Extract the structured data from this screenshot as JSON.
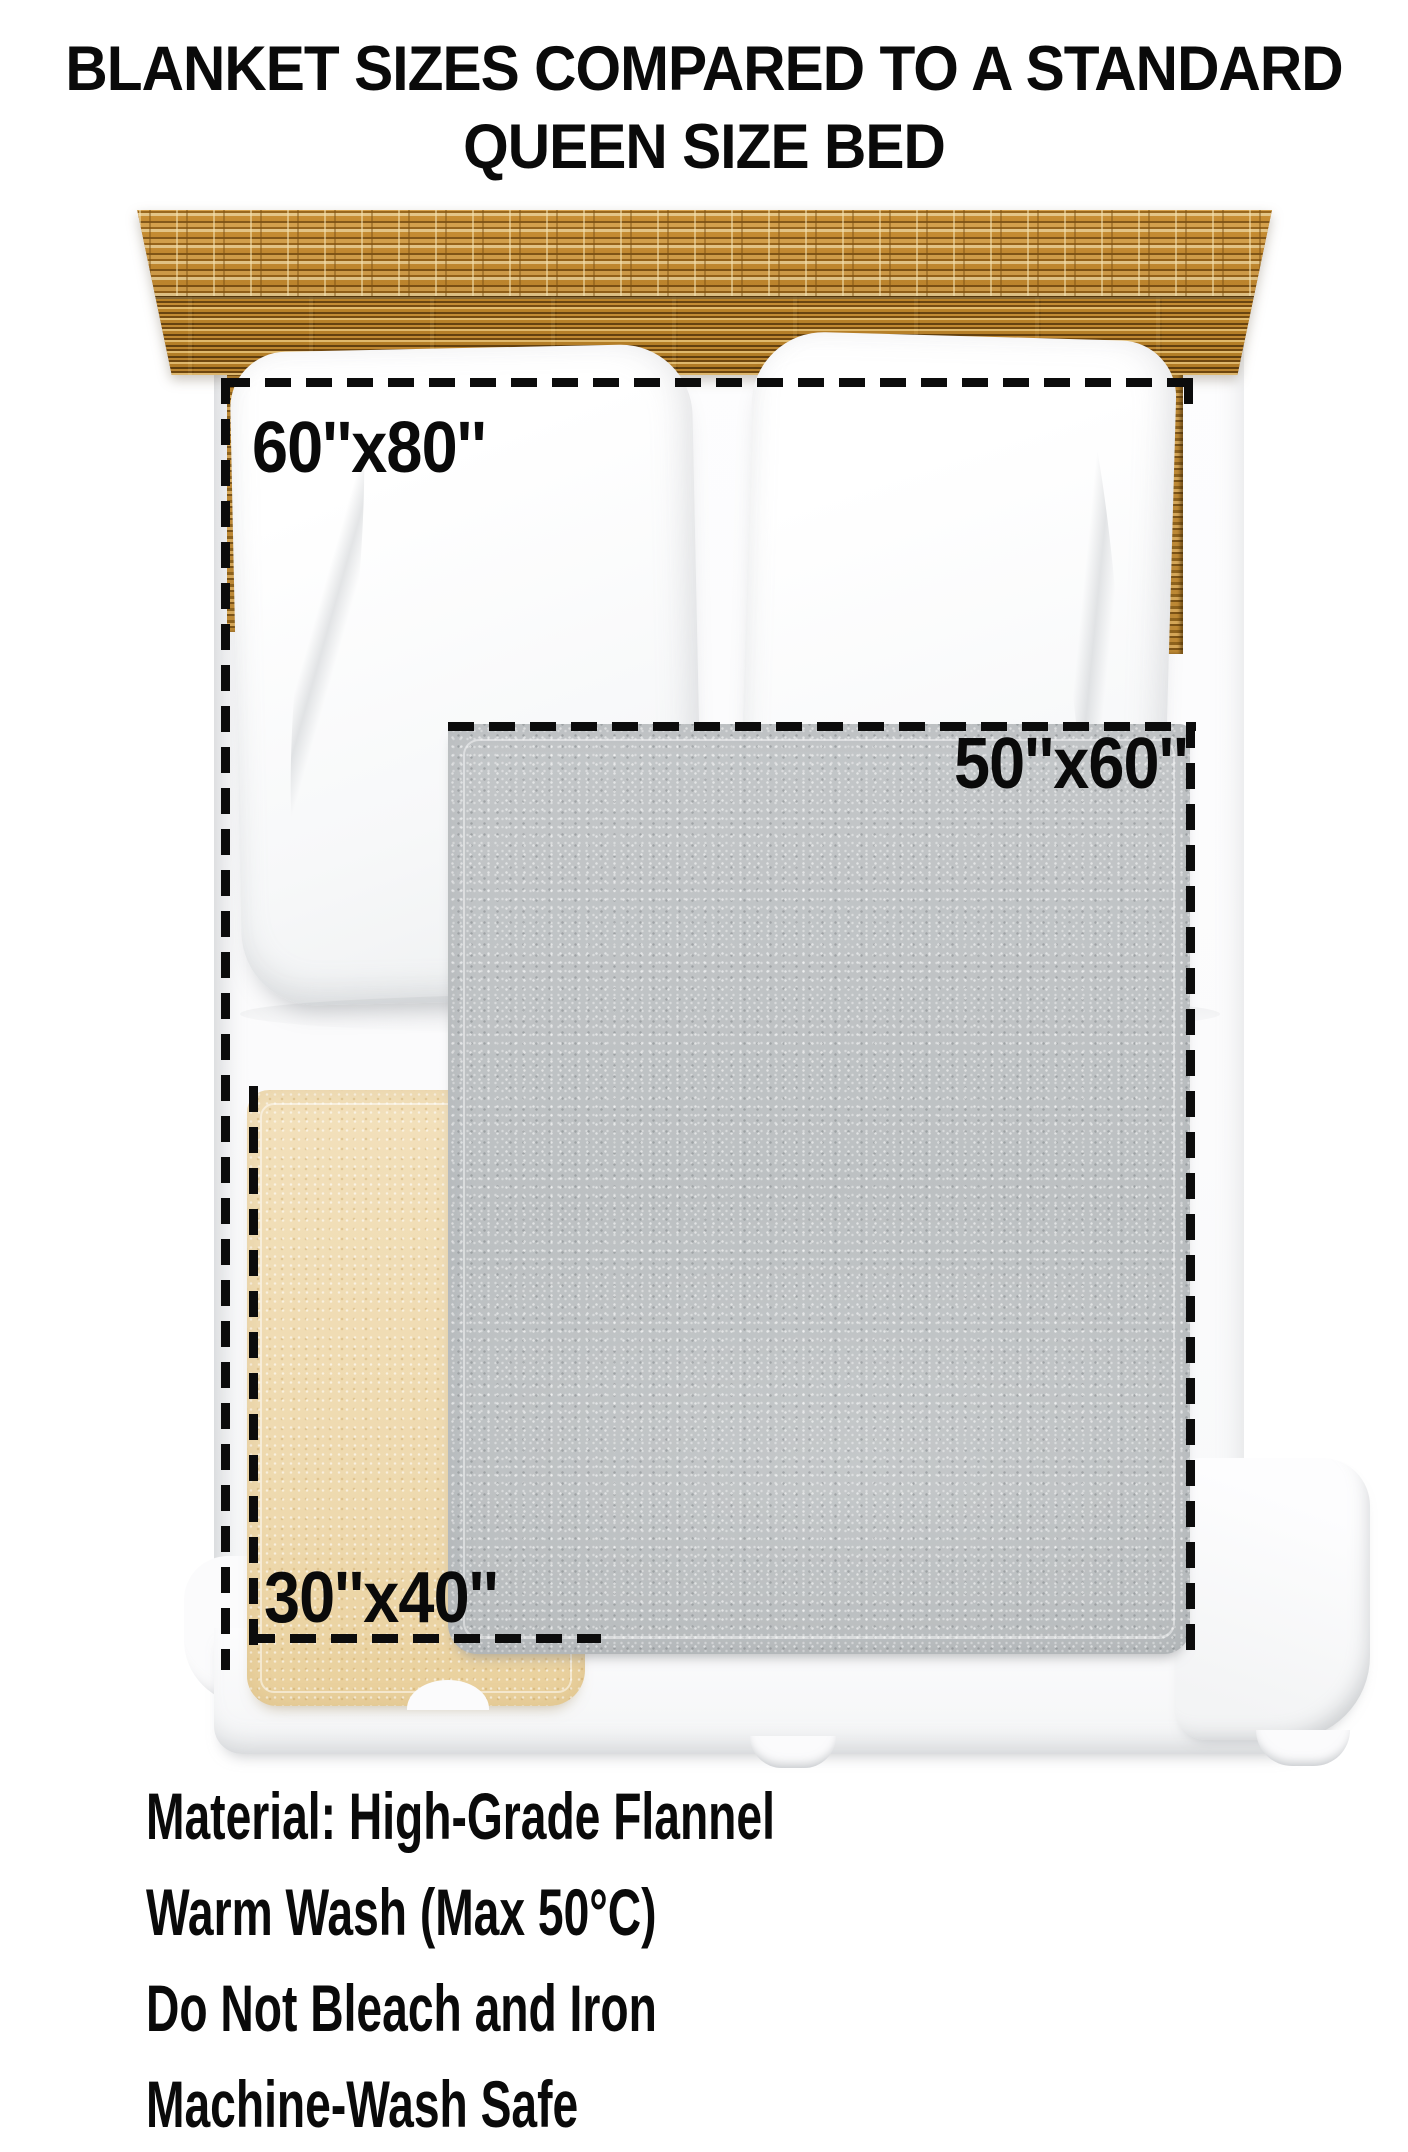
{
  "title": {
    "line1": "BLANKET SIZES COMPARED TO A STANDARD",
    "line2": "QUEEN SIZE BED"
  },
  "blankets": [
    {
      "size_label": "60''x80''"
    },
    {
      "size_label": "50''x60''"
    },
    {
      "size_label": "30''x40''"
    }
  ],
  "care_info": {
    "lines": [
      "Material: High-Grade Flannel",
      "Warm Wash (Max 50°C)",
      "Do Not Bleach and Iron",
      "Machine-Wash Safe"
    ]
  },
  "colors": {
    "bg": "#ffffff",
    "ink": "#0a0a0a",
    "dash": "#0c0c0c",
    "wood_base": "#b97f2b",
    "wood_light": "#eed9a4",
    "wood_dark": "#6b4712",
    "blanket_gray": "#bfc2c4",
    "blanket_beige": "#f0ddb4",
    "bed_white": "#fbfbfc"
  }
}
